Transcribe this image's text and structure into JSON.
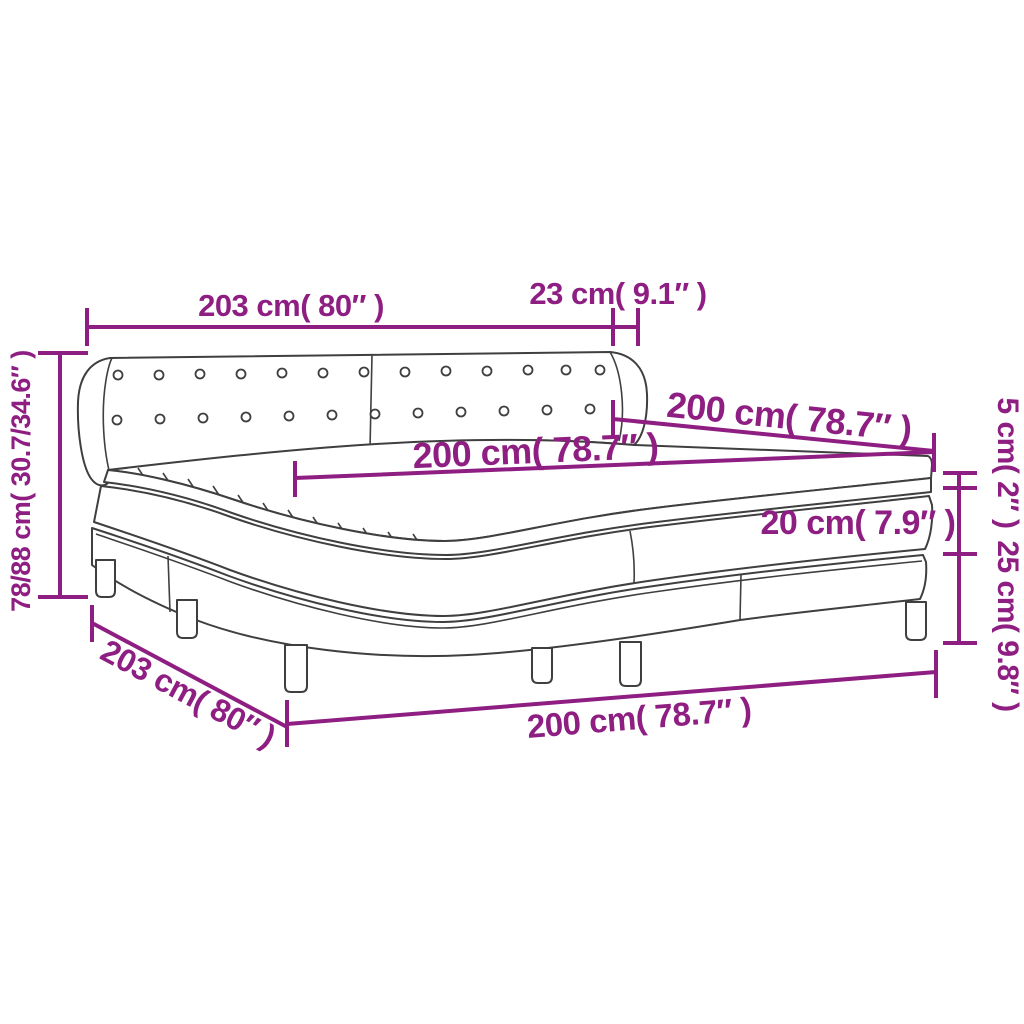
{
  "title": "Box spring bed dimension diagram",
  "colors": {
    "dimension_accent": "#8e1e82",
    "line_art": "#3f3f3f",
    "background": "#ffffff"
  },
  "labels": {
    "headboard_width": "203 cm( 80″ )",
    "wing_depth": "23 cm( 9.1″ )",
    "bed_depth": "200 cm( 78.7″ )",
    "mattress_width": "200 cm( 78.7″ )",
    "total_height": "78/88 cm( 30.7/34.6″ )",
    "topper_thickness": "5 cm( 2″ )",
    "mattress_thickness": "20 cm( 7.9″ )",
    "base_height": "25 cm( 9.8″ )",
    "side_length": "203 cm( 80″ )",
    "base_width": "200 cm( 78.7″ )"
  }
}
